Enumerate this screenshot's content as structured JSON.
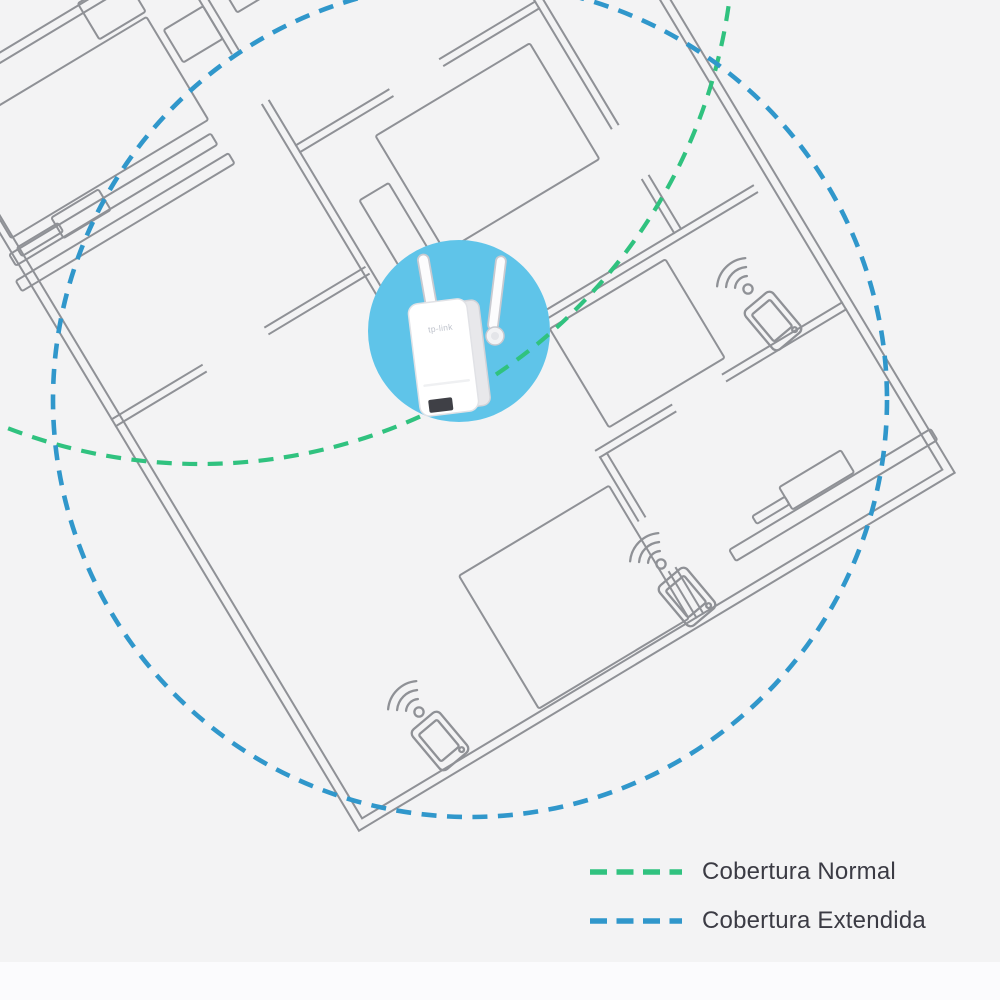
{
  "page": {
    "background_color": "#f3f3f4",
    "footer_band_color": "#fbfbfd"
  },
  "floorplan": {
    "wall_color": "#8f9196",
    "description": "Rotated apartment floor plan with room walls and furniture outlines"
  },
  "extender": {
    "brand_label": "tp-link",
    "type": "wifi-range-extender",
    "highlight_color": "#5fc4e9"
  },
  "coverage": {
    "normal": {
      "label": "Cobertura Normal",
      "color": "#30c27f",
      "line_style": "dashed"
    },
    "extended": {
      "label": "Cobertura Extendida",
      "color": "#3097cb",
      "line_style": "dashed"
    }
  },
  "legend": {
    "items": [
      {
        "label": "Cobertura Normal",
        "color": "#30c27f"
      },
      {
        "label": "Cobertura Extendida",
        "color": "#3097cb"
      }
    ]
  },
  "client_devices": [
    {
      "type": "smartphone",
      "signal": "wifi",
      "position": "top-right room"
    },
    {
      "type": "smartphone",
      "signal": "wifi",
      "position": "center-right bedroom"
    },
    {
      "type": "smartphone",
      "signal": "wifi",
      "position": "bottom-left room"
    }
  ]
}
